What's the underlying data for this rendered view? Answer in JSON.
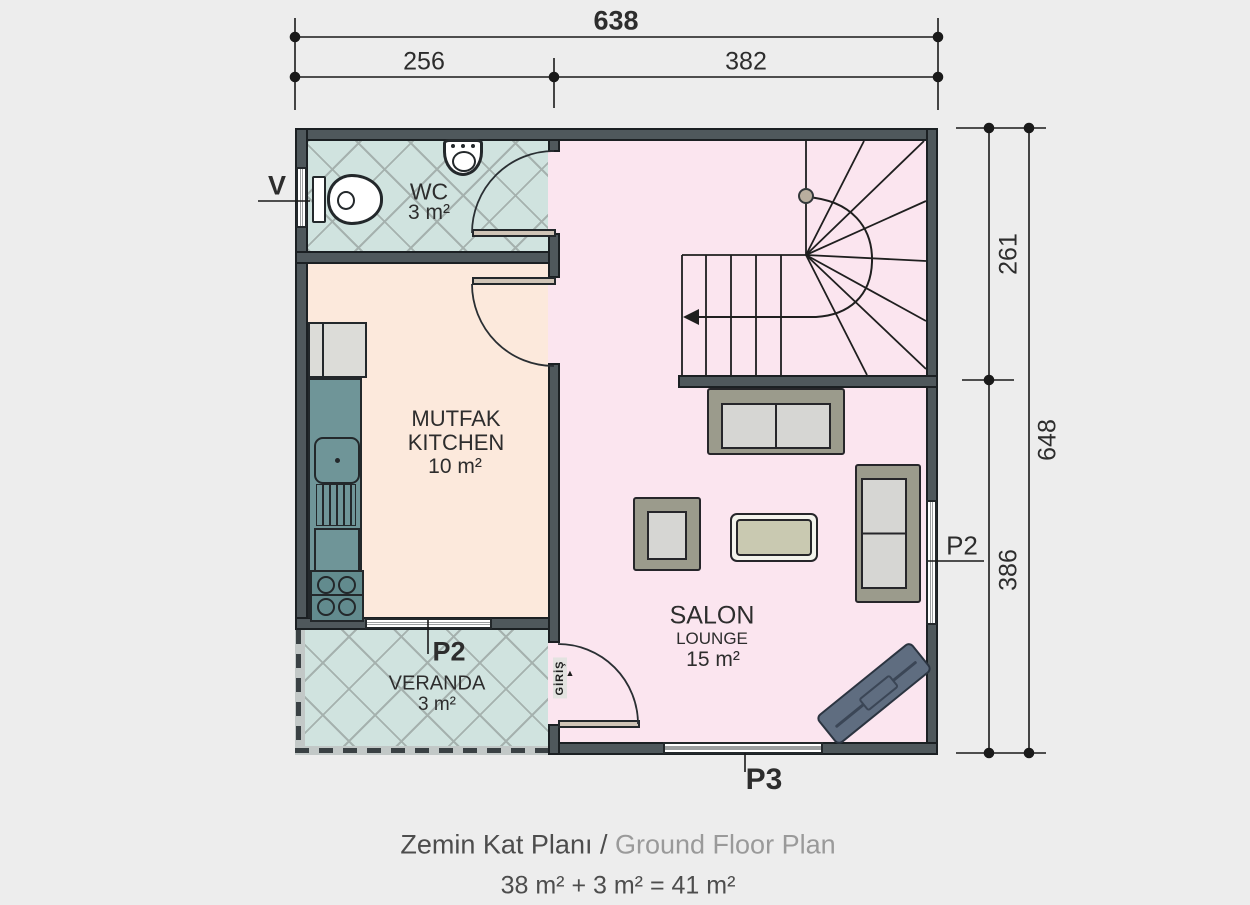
{
  "plan": {
    "dims": {
      "top_total": "638",
      "top_left": "256",
      "top_right": "382",
      "right_upper": "261",
      "right_lower": "386",
      "right_total": "648"
    },
    "openings": {
      "v_window": "V",
      "p2_veranda_window": "P2",
      "p2_salon_window": "P2",
      "p3_window": "P3",
      "entrance": "GİRİŞ",
      "entrance_arrow": "▲"
    },
    "rooms": {
      "wc": {
        "name": "WC",
        "area": "3 m²"
      },
      "kitchen": {
        "name_tr": "MUTFAK",
        "name_en": "KITCHEN",
        "area": "10 m²"
      },
      "salon": {
        "name_tr": "SALON",
        "name_en": "LOUNGE",
        "area": "15 m²"
      },
      "veranda": {
        "name": "VERANDA",
        "area": "3 m²"
      }
    },
    "caption": {
      "title_tr": "Zemin Kat Planı /",
      "title_en": "Ground Floor Plan",
      "area_sum": "38 m² + 3 m² = 41 m²"
    },
    "colors": {
      "wall": "#4f585c",
      "salon_floor": "#fbe5ef",
      "kitchen_floor": "#fce9dc",
      "tile_floor": "#d0e3df",
      "counter": "#6f9598",
      "sofa_frame": "#9b9b8c",
      "tv_unit": "#5f6d80"
    }
  }
}
